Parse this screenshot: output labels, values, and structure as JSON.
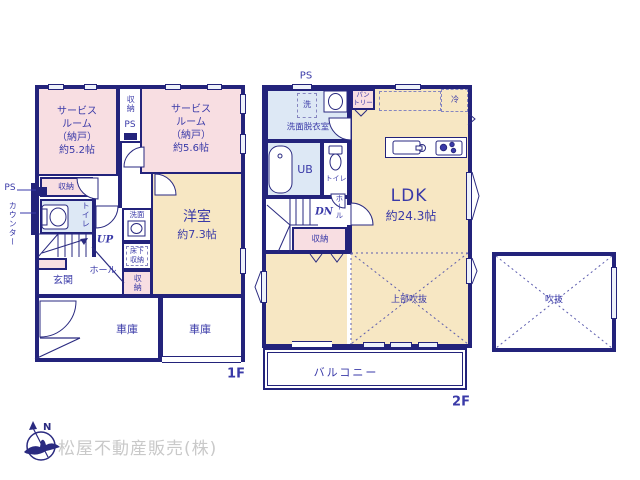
{
  "colors": {
    "wall": "#23237b",
    "room_text": "#3a3aa8",
    "pink_room": "#f8dee2",
    "cream_room": "#f7e7c3",
    "light_blue_room": "#dde8f5",
    "company_gray": "#c9c9c9"
  },
  "floor1": {
    "label": "1F",
    "side_ps": "PS",
    "side_counter": "カウンター",
    "service_room_1": "サービス\nルーム\n（納戸）\n約5.2帖",
    "mid_closet": "収納",
    "mid_ps": "PS",
    "service_room_2": "サービス\nルーム\n（納戸）\n約5.6帖",
    "closet_strip": "収納",
    "toilet": "トイレ",
    "up": "UP",
    "washbasin": "洗面",
    "underfloor_storage": "床下\n収納",
    "closet_vertical": "収納",
    "bedroom_name": "洋室",
    "bedroom_size": "約7.3帖",
    "entrance": "玄関",
    "hall": "ホール",
    "garage_left": "車庫",
    "garage_right": "車庫"
  },
  "floor2": {
    "label": "2F",
    "top_ps": "PS",
    "laundry": "洗",
    "washroom": "洗面脱衣室",
    "pantry": "パン\nトリー",
    "fridge": "冷",
    "ldk_name": "LDK",
    "ldk_size": "約24.3帖",
    "bath": "UB",
    "toilet": "トイレ",
    "dn": "DN",
    "hall": "ホール",
    "closet": "収納",
    "upper_void": "上部吹抜",
    "balcony": "バルコニー"
  },
  "void_box": {
    "label": "吹抜"
  },
  "footer": {
    "company": "松屋不動産販売(株)",
    "compass_north": "N"
  }
}
